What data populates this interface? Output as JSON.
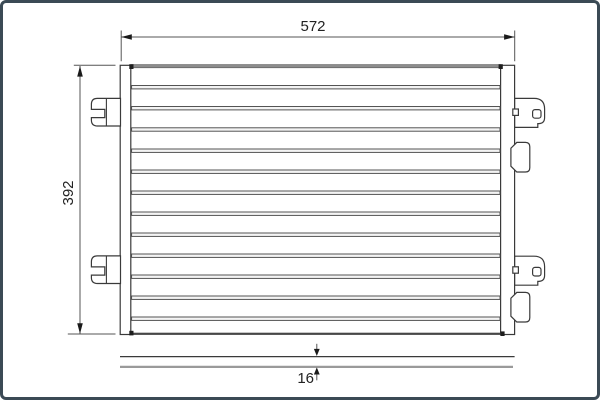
{
  "drawing": {
    "labels": {
      "width": "572",
      "height": "392",
      "depth": "16"
    },
    "colors": {
      "frame_border": "#3b4a55",
      "line": "#3a3a3a",
      "dim": "#555555",
      "arrow": "#1a1a1a",
      "tube_fill": "#f4f4f4",
      "core_top": "#8d8d8d",
      "side_gray": "#9a9a9a",
      "text": "#222222"
    }
  }
}
